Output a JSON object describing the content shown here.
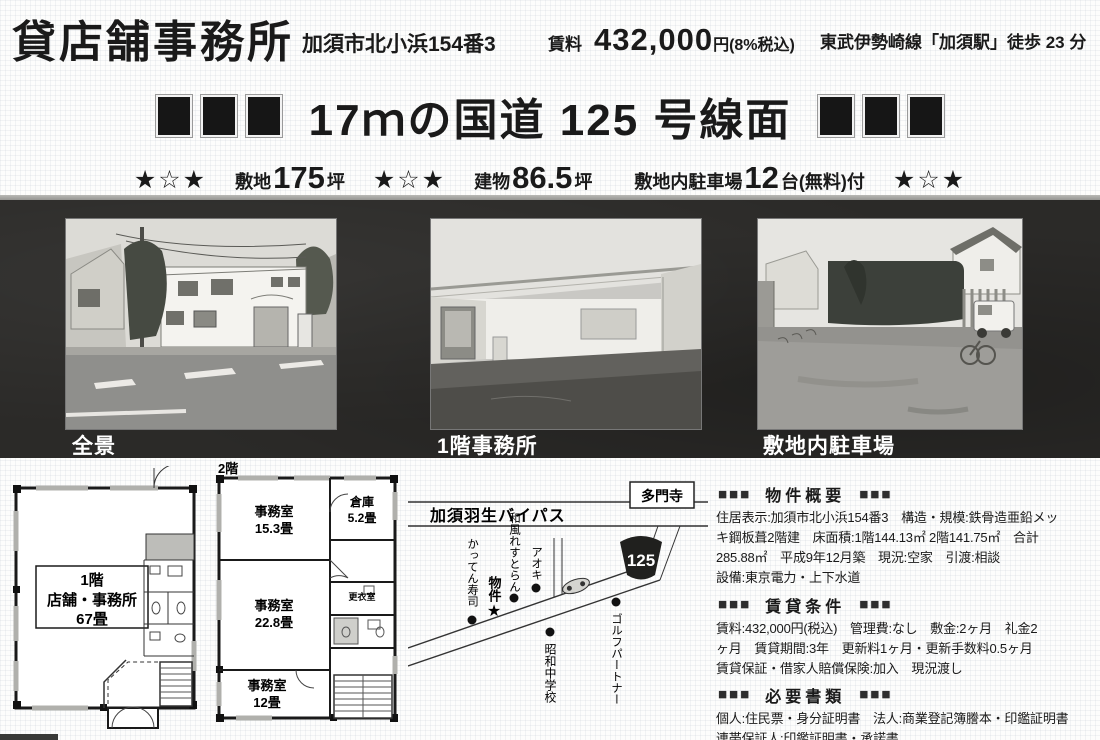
{
  "header": {
    "title": "貸店舗事務所",
    "address": "加須市北小浜154番3",
    "rent_label": "賃料",
    "rent_amount": "432,000",
    "rent_suffix": "円(8%税込)",
    "access": "東武伊勢崎線「加須駅」徒歩 23 分"
  },
  "headline": {
    "text": "17ｍの国道 125 号線面"
  },
  "highlights": {
    "stars": "★☆★",
    "site_label": "敷地",
    "site_value": "175",
    "site_unit": "坪",
    "building_label": "建物",
    "building_value": "86.5",
    "building_unit": "坪",
    "parking_label": "敷地内駐車場",
    "parking_value": "12",
    "parking_unit": "台(無料)付"
  },
  "photos": [
    {
      "caption": "全景"
    },
    {
      "caption": "1階事務所"
    },
    {
      "caption": "敷地内駐車場"
    }
  ],
  "floorplan_1f": {
    "line1": "1階",
    "line2": "店舗・事務所",
    "line3": "67畳"
  },
  "floorplan_2f": {
    "floor_label": "2階",
    "room1_name": "事務室",
    "room1_size": "15.3畳",
    "room2_name": "倉庫",
    "room2_size": "5.2畳",
    "room3_name": "事務室",
    "room3_size": "22.8畳",
    "room4_name": "更衣室",
    "room5_name": "事務室",
    "room5_size": "12畳"
  },
  "map": {
    "bypass": "加須羽生バイパス",
    "temple": "多門寺",
    "route": "125",
    "landmark_sushi": "かってん寿司",
    "landmark_property": "物件",
    "property_star": "★",
    "landmark_restaurant": "和風れすとらん",
    "landmark_aoki": "アオキ",
    "landmark_school": "昭和中学校",
    "landmark_golf": "ゴルフパートナー"
  },
  "details": {
    "marker": "■■■",
    "sections": [
      {
        "title": "物件概要",
        "lines": [
          "住居表示:加須市北小浜154番3　構造・規模:鉄骨造亜鉛メッ",
          "キ鋼板葺2階建　床面積:1階144.13㎡ 2階141.75㎡　合計",
          "285.88㎡　平成9年12月築　現況:空家　引渡:相談",
          "設備:東京電力・上下水道"
        ]
      },
      {
        "title": "賃貸条件",
        "lines": [
          "賃料:432,000円(税込)　管理費:なし　敷金:2ヶ月　礼金2",
          "ヶ月　賃貸期間:3年　更新料1ヶ月・更新手数料0.5ヶ月",
          "賃貸保証・借家人賠償保険:加入　現況渡し"
        ]
      },
      {
        "title": "必要書類",
        "lines": [
          "個人:住民票・身分証明書　法人:商業登記簿謄本・印鑑証明書",
          "連帯保証人:印鑑証明書・承諾書"
        ]
      }
    ]
  },
  "colors": {
    "ink": "#1a1a1a",
    "photo_band_bg": "#2b2a28",
    "caption_text": "#ffffff"
  }
}
